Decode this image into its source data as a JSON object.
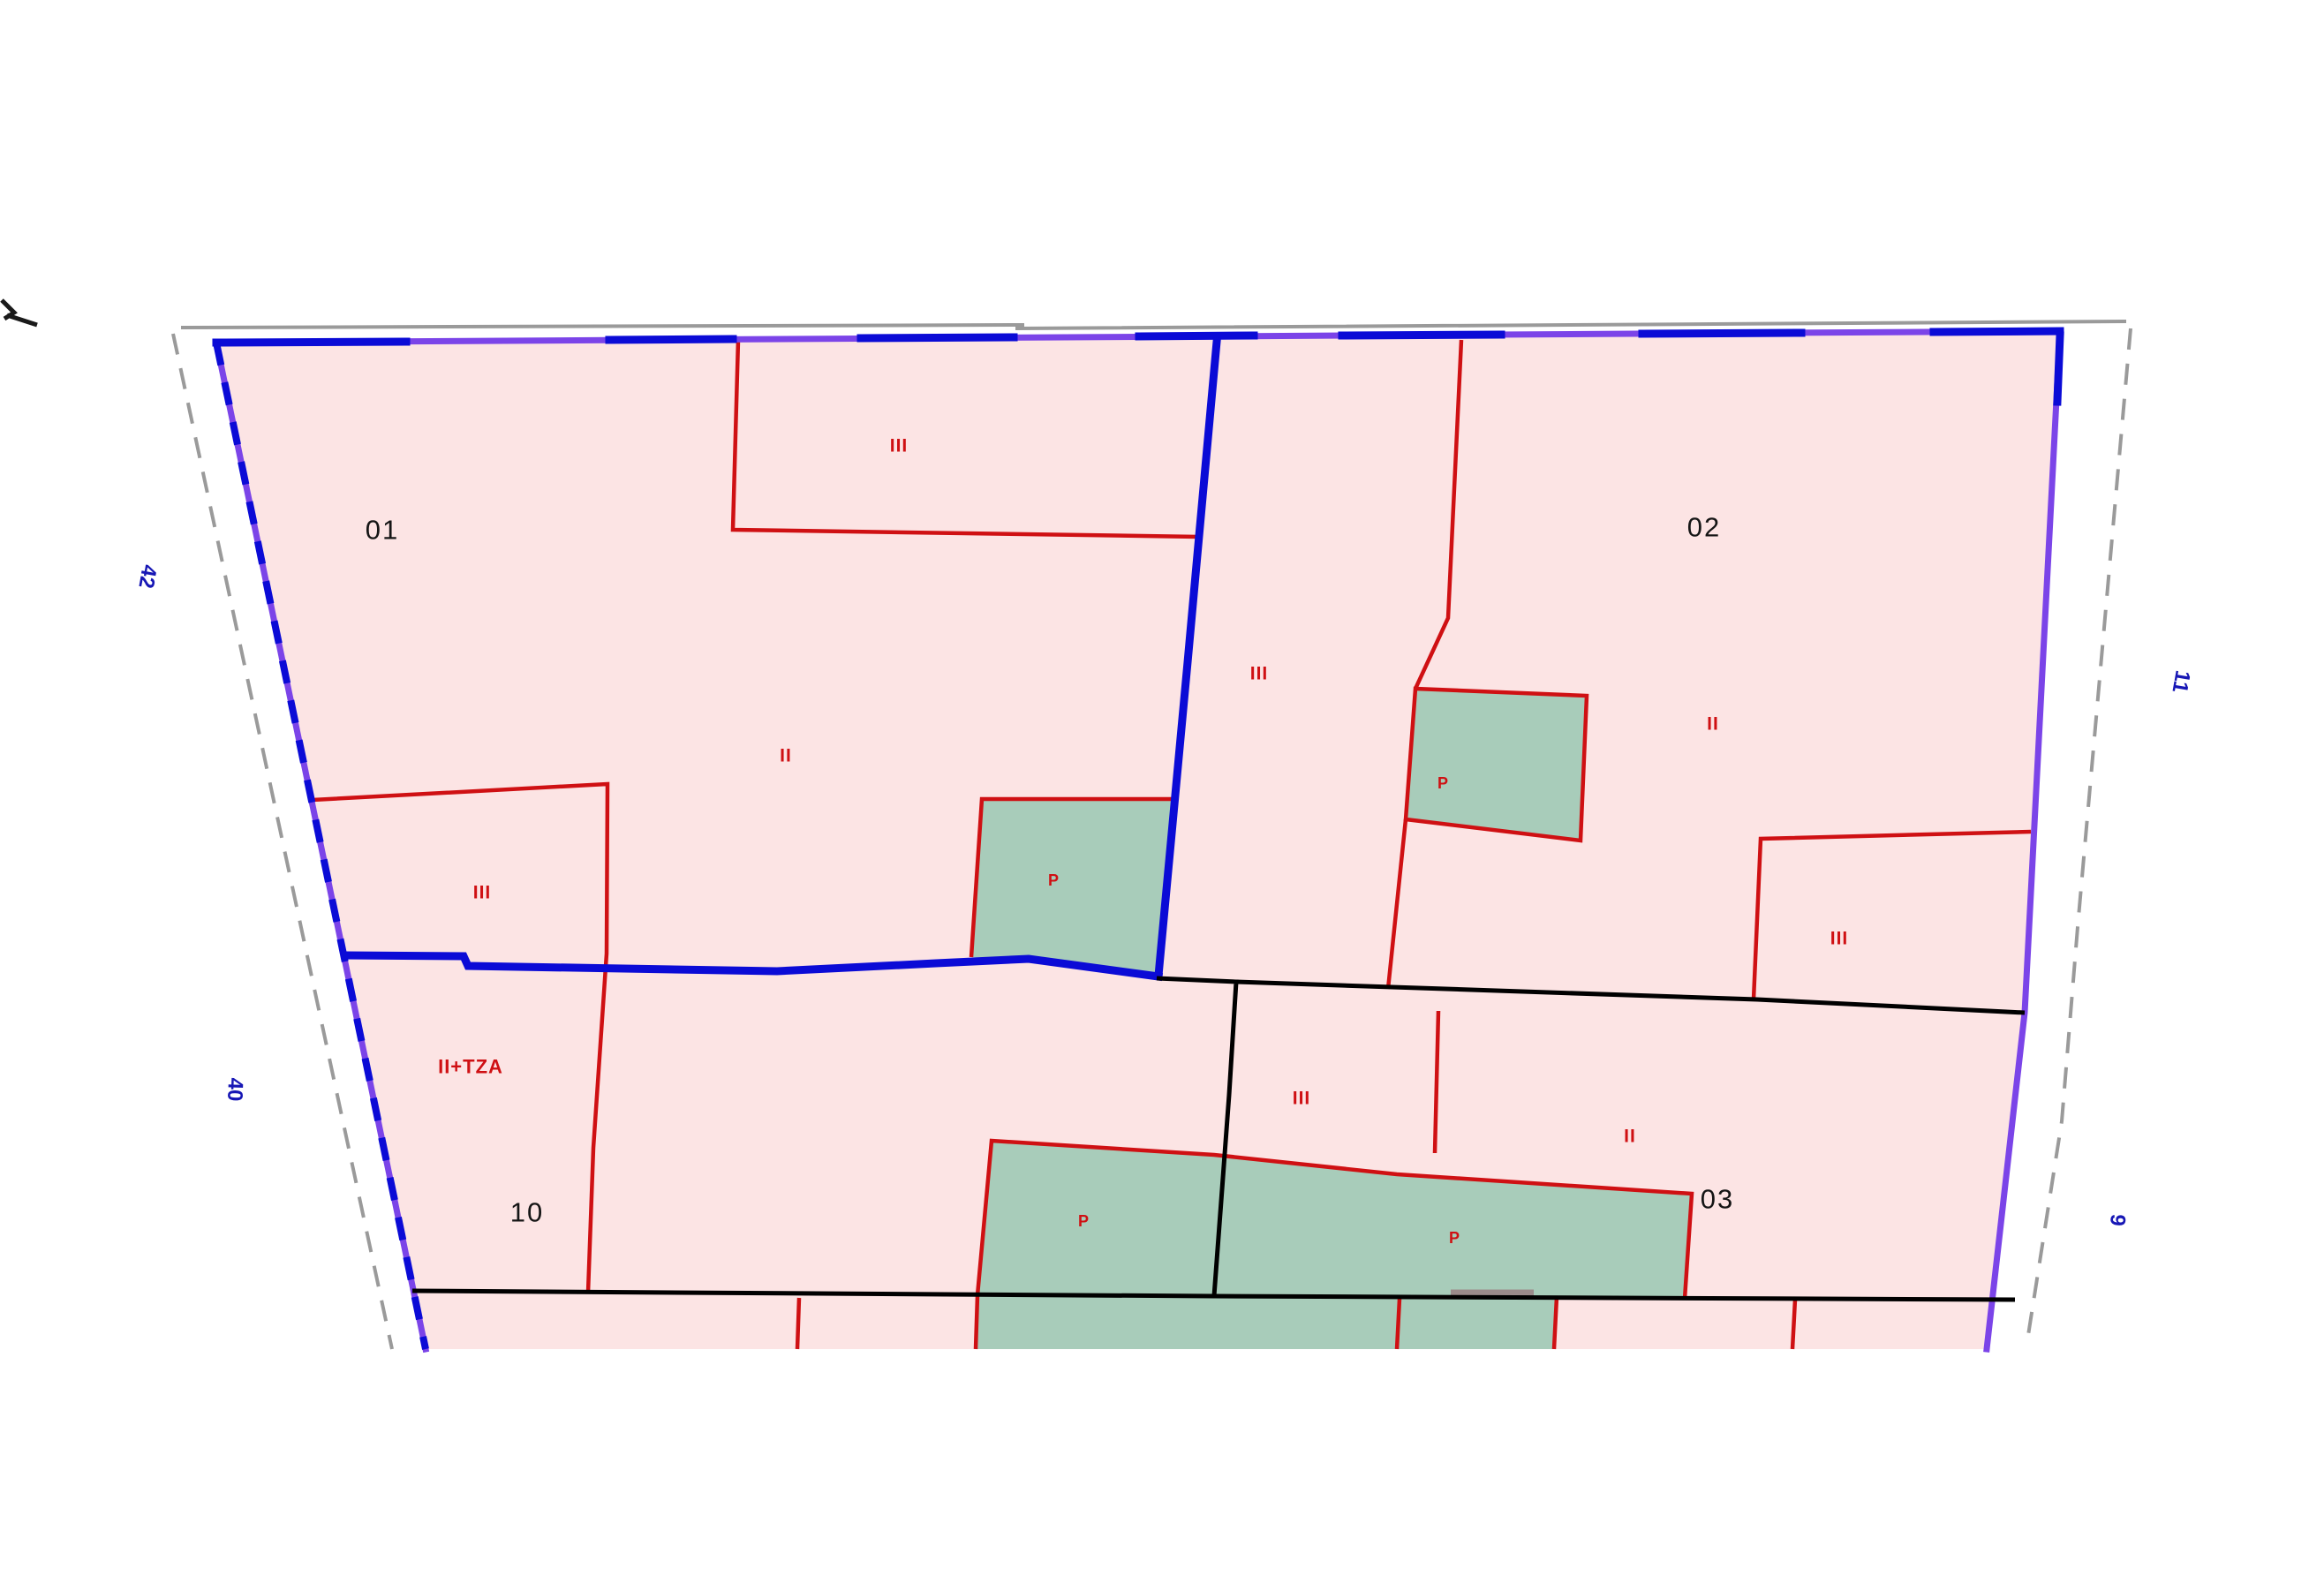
{
  "page": {
    "background": "#ffffff",
    "content_type": "cadastral parcel map detail"
  },
  "labels": {
    "parcel_01": "01",
    "parcel_02": "02",
    "parcel_03": "03",
    "parcel_10": "10",
    "height_three_floors": "III",
    "height_two_floors": "II",
    "height_two_plus_terrace": "II+TZA",
    "patio": "P"
  },
  "street_numbers": {
    "left_upper": "42",
    "left_lower": "40",
    "right_upper": "11",
    "right_lower": "9"
  },
  "colors": {
    "parcel_fill": "#fce4e4",
    "patio_fill": "#a8ccba",
    "building_line": "#cf1013",
    "parcel_boundary_blue": "#0b0bd6",
    "boundary_purple": "#7b44e8",
    "street_text": "#1717b5",
    "outer_line_gray": "#9a9a9a",
    "curb_line_gray": "#9b8b8b",
    "division_line_black": "#000000",
    "parcel_number_text": "#151515"
  }
}
